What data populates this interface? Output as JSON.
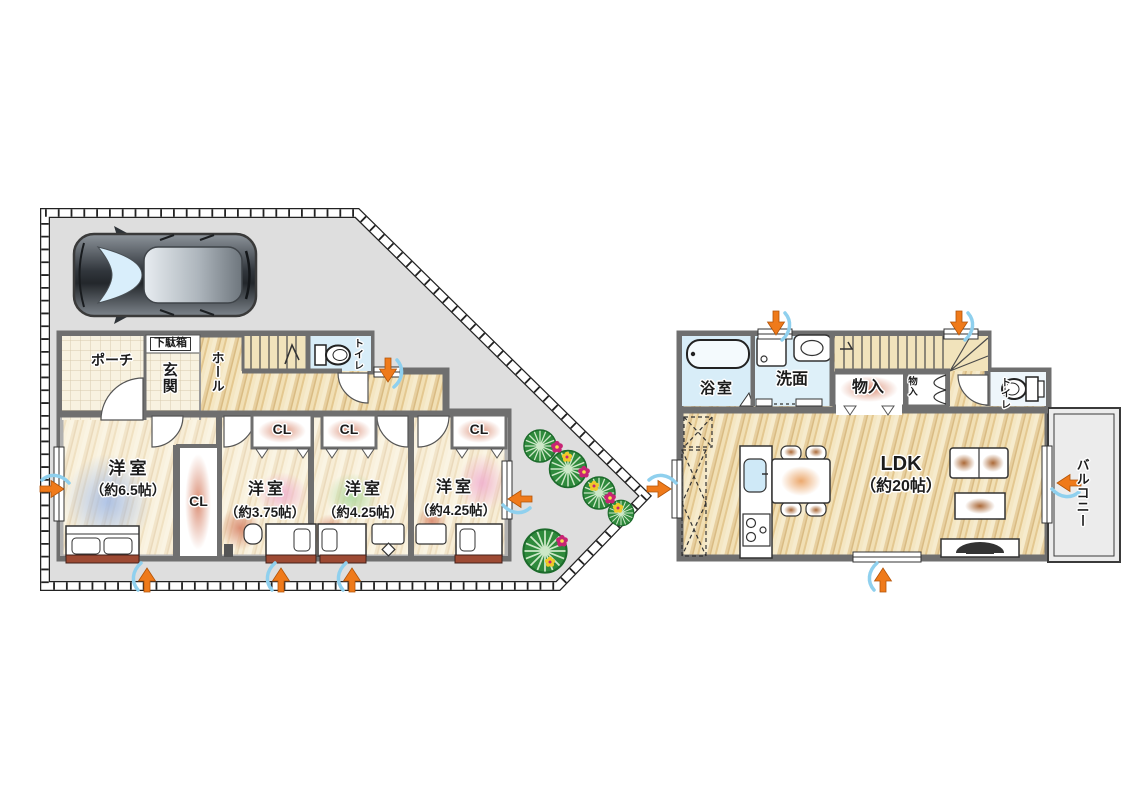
{
  "floor1": {
    "porch_label": "ポーチ",
    "shoe_cabinet_label": "下駄箱",
    "entrance_label": "玄関",
    "hall_label": "ホール",
    "toilet_label": "トイレ",
    "closet_label": "CL",
    "bedroom1_name": "洋室",
    "bedroom1_size": "（約6.5帖）",
    "bedroom2_name": "洋室",
    "bedroom2_size": "（約3.75帖）",
    "bedroom3_name": "洋室",
    "bedroom3_size": "（約4.25帖）",
    "bedroom4_name": "洋室",
    "bedroom4_size": "（約4.25帖）"
  },
  "floor2": {
    "bath_label": "浴室",
    "washroom_label": "洗面",
    "storage_label": "物入",
    "storage_small_label": "物入",
    "toilet_label": "トイレ",
    "ldk_name": "LDK",
    "ldk_size": "（約20帖）",
    "balcony_label": "バルコニー"
  },
  "colors": {
    "wall": "#6f6f6f",
    "site_fill": "#dedede",
    "wet_area": "#d8edf8",
    "wood_base": "#f2e2bb",
    "vent_orange": "#ef7a1a",
    "vent_blue": "#8fd0ee"
  }
}
